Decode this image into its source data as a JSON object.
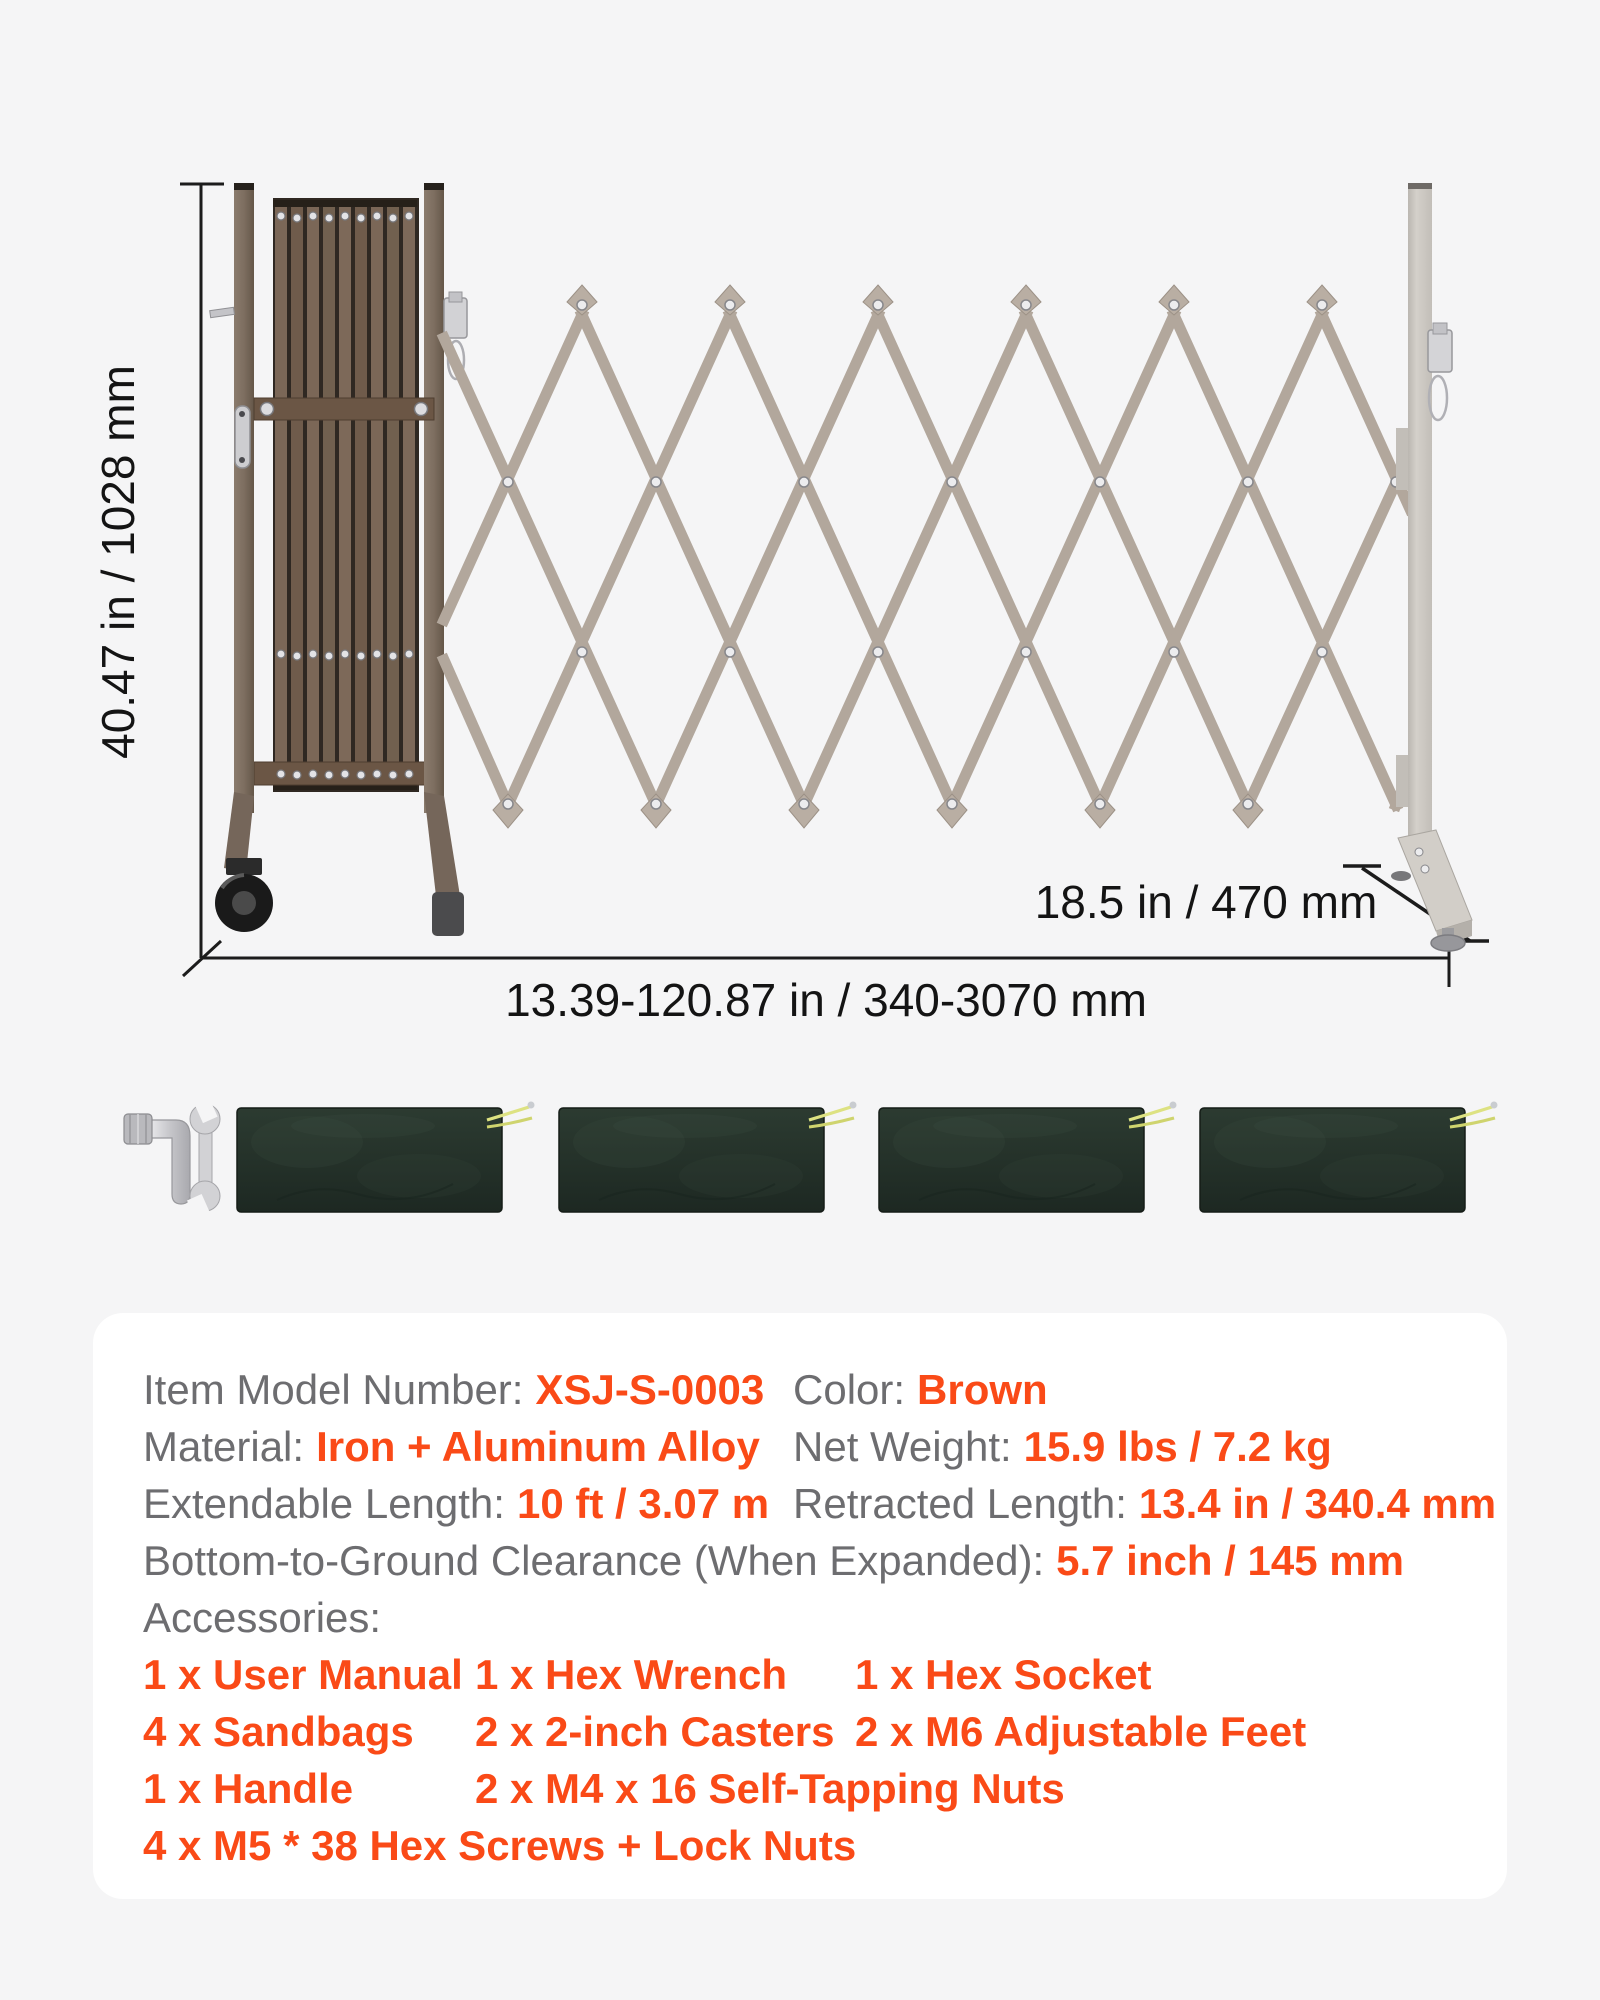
{
  "page": {
    "background": "#f5f5f6",
    "panel_background": "#ffffff",
    "accent_color": "#fa4a17",
    "label_color": "#6d6d70",
    "dimension_text_color": "#141414"
  },
  "dimensions": {
    "height": "40.47 in / 1028 mm",
    "length": "13.39-120.87 in / 340-3070 mm",
    "depth": "18.5 in / 470 mm"
  },
  "specs": {
    "model_label": "Item Model Number:",
    "model_value": "XSJ-S-0003",
    "color_label": "Color:",
    "color_value": "Brown",
    "material_label": "Material:",
    "material_value": "Iron + Aluminum Alloy",
    "weight_label": "Net Weight:",
    "weight_value": "15.9 lbs / 7.2 kg",
    "extendable_label": "Extendable Length:",
    "extendable_value": "10 ft / 3.07 m",
    "retracted_label": "Retracted Length:",
    "retracted_value": "13.4 in / 340.4 mm",
    "clearance_label": "Bottom-to-Ground Clearance (When Expanded):",
    "clearance_value": "5.7 inch / 145 mm",
    "accessories_label": "Accessories:"
  },
  "accessories": {
    "rows": [
      [
        "1 x User Manual",
        "1 x Hex Wrench",
        "1 x Hex Socket"
      ],
      [
        "4 x Sandbags",
        "2 x 2-inch Casters",
        "2 x M6 Adjustable Feet"
      ],
      [
        "1 x Handle",
        "2 x M4 x 16 Self-Tapping Nuts"
      ],
      [
        "4 x M5 * 38 Hex Screws + Lock Nuts"
      ]
    ]
  },
  "illustration": {
    "sandbag_count": 4,
    "lattice_color": "#b2a79c",
    "frame_brown_color": "#7a6a5c",
    "right_post_color": "#cdc9c3",
    "sandbag_color": "#25332b"
  }
}
